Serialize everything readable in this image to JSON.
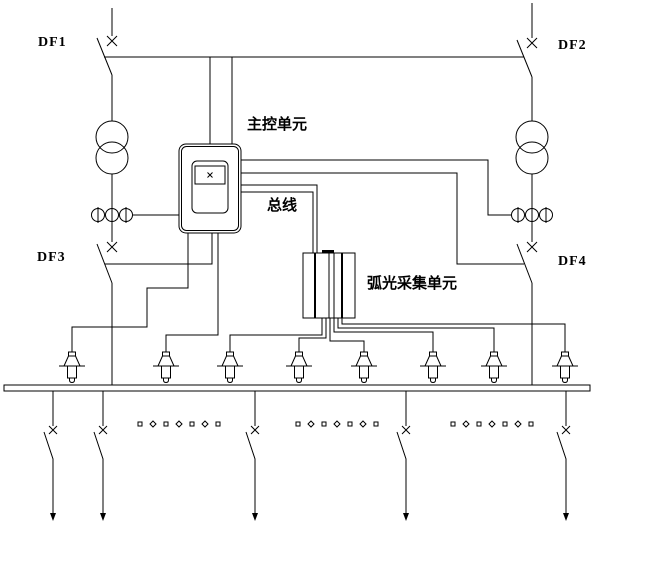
{
  "diagram": {
    "kind": "arc-flash-protection-single-line-schematic",
    "labels": {
      "df1": "DF1",
      "df2": "DF2",
      "df3": "DF3",
      "df4": "DF4",
      "main_control_unit": "主控单元",
      "bus": "总线",
      "arc_collection_unit": "弧光采集单元"
    },
    "colors": {
      "line": "#000000",
      "background": "#ffffff"
    },
    "counts": {
      "breakers_labeled": 4,
      "transformers": 2,
      "ct_sets": 2,
      "arc_sensors": 8,
      "outgoing_feeders": 5,
      "omitted_feeder_dot_groups": 3
    }
  }
}
